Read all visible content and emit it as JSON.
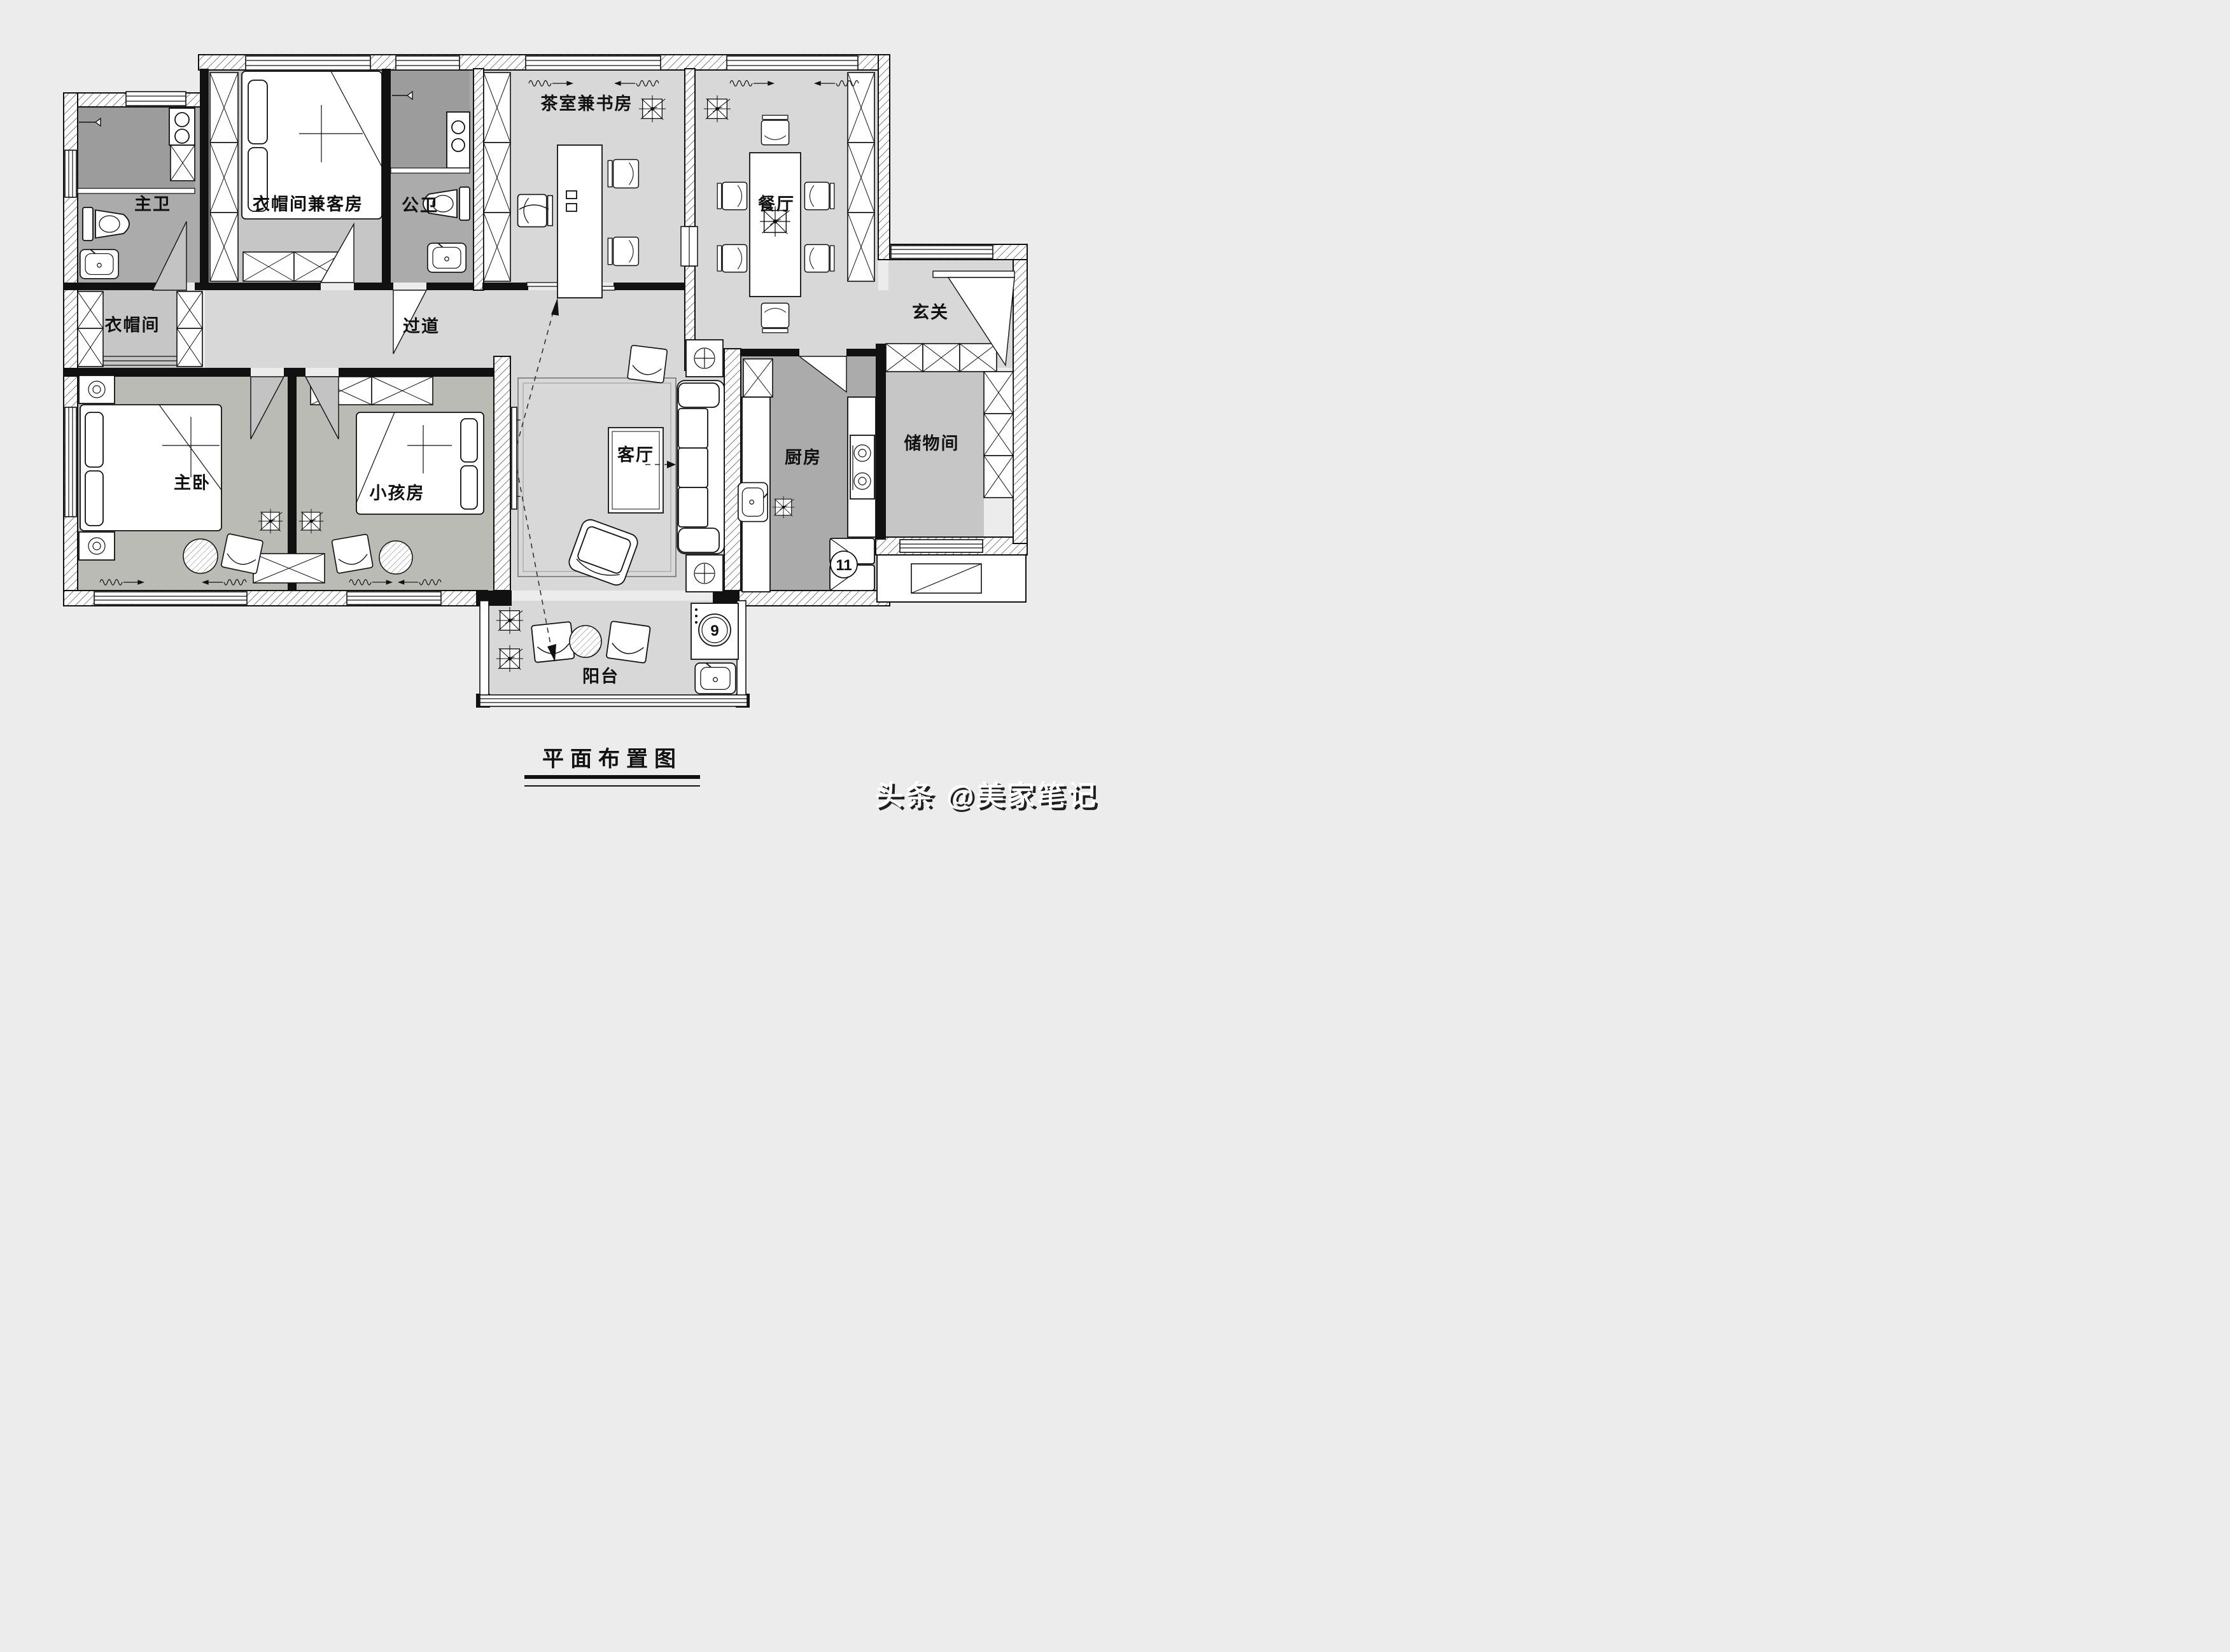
{
  "document": {
    "title_text": "平面布置图",
    "watermark_text": "头条 @美家笔记"
  },
  "rooms": [
    {
      "id": "master-bath",
      "label": "主卫"
    },
    {
      "id": "cloak-guest",
      "label": "衣帽间兼客房"
    },
    {
      "id": "public-bath",
      "label": "公卫"
    },
    {
      "id": "tea-study",
      "label": "茶室兼书房"
    },
    {
      "id": "dining",
      "label": "餐厅"
    },
    {
      "id": "cloakroom",
      "label": "衣帽间"
    },
    {
      "id": "hallway",
      "label": "过道"
    },
    {
      "id": "entry",
      "label": "玄关"
    },
    {
      "id": "master-bedroom",
      "label": "主卧"
    },
    {
      "id": "kids-room",
      "label": "小孩房"
    },
    {
      "id": "living",
      "label": "客厅"
    },
    {
      "id": "kitchen",
      "label": "厨房"
    },
    {
      "id": "storage",
      "label": "储物间"
    },
    {
      "id": "balcony",
      "label": "阳台"
    }
  ],
  "appliances": {
    "washing_machine_no": "9",
    "refrigerator_no": "11"
  },
  "colors": {
    "background": "#ececec",
    "floor_light": "#d8d8d8",
    "floor_mid": "#c6c6c6",
    "floor_bedroom": "#b9bbb4",
    "floor_service": "#ababab",
    "floor_shower": "#9c9c9c",
    "wall": "#111111",
    "furniture": "#ffffff"
  }
}
